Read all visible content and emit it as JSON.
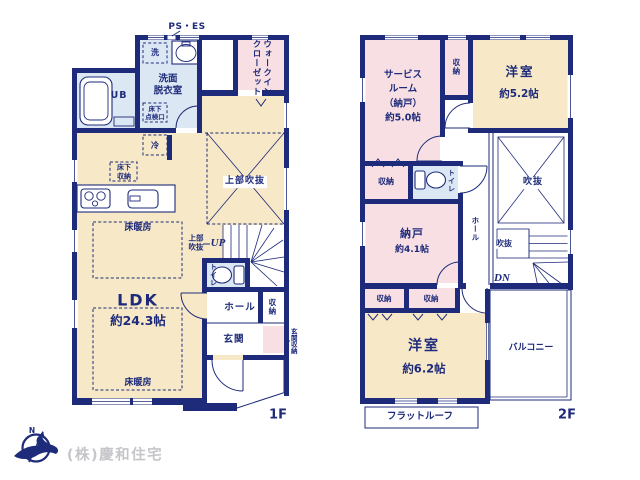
{
  "meta": {
    "ps_es": "PS・ES",
    "floor1_label": "1F",
    "floor2_label": "2F",
    "company": "(株)慶和住宅",
    "compass_n": "N"
  },
  "colors": {
    "wall": "#1e2b7a",
    "room_beige": "#f7e8c8",
    "room_pink": "#f8dfe4",
    "room_blue": "#dce7f4",
    "text_gray": "#c6c6ca"
  },
  "floor1": {
    "washer": "洗",
    "washroom": "洗面\n脱衣室",
    "ub": "UB",
    "wic": "ウォークイン\nクローゼット",
    "hatch": "床下\n点検口",
    "fridge": "冷",
    "underfloor_storage": "床下\n収納",
    "upper_void": "上部吹抜",
    "upper_void_small": "上部\n吹抜",
    "up": "UP",
    "toilet": "トイレ",
    "hall": "ホール",
    "hall_storage": "収納",
    "entrance": "玄関",
    "entrance_storage": "玄関収納",
    "ldk": "LDK",
    "ldk_size": "約24.3帖",
    "floor_heating": "床暖房"
  },
  "floor2": {
    "service_room": "サービス\nルーム\n（納戸）\n約5.0帖",
    "storage_top": "収納",
    "bedroom52": "洋室",
    "bedroom52_size": "約5.2帖",
    "void": "吹抜",
    "storage_left": "収納",
    "toilet": "トイレ",
    "nando": "納戸",
    "nando_size": "約4.1帖",
    "hall": "ホール",
    "void_small": "吹抜",
    "dn": "DN",
    "storage_a": "収納",
    "storage_b": "収納",
    "bedroom62": "洋室",
    "bedroom62_size": "約6.2帖",
    "balcony": "バルコニー",
    "flat_roof": "フラットルーフ",
    "2f": "2F"
  }
}
